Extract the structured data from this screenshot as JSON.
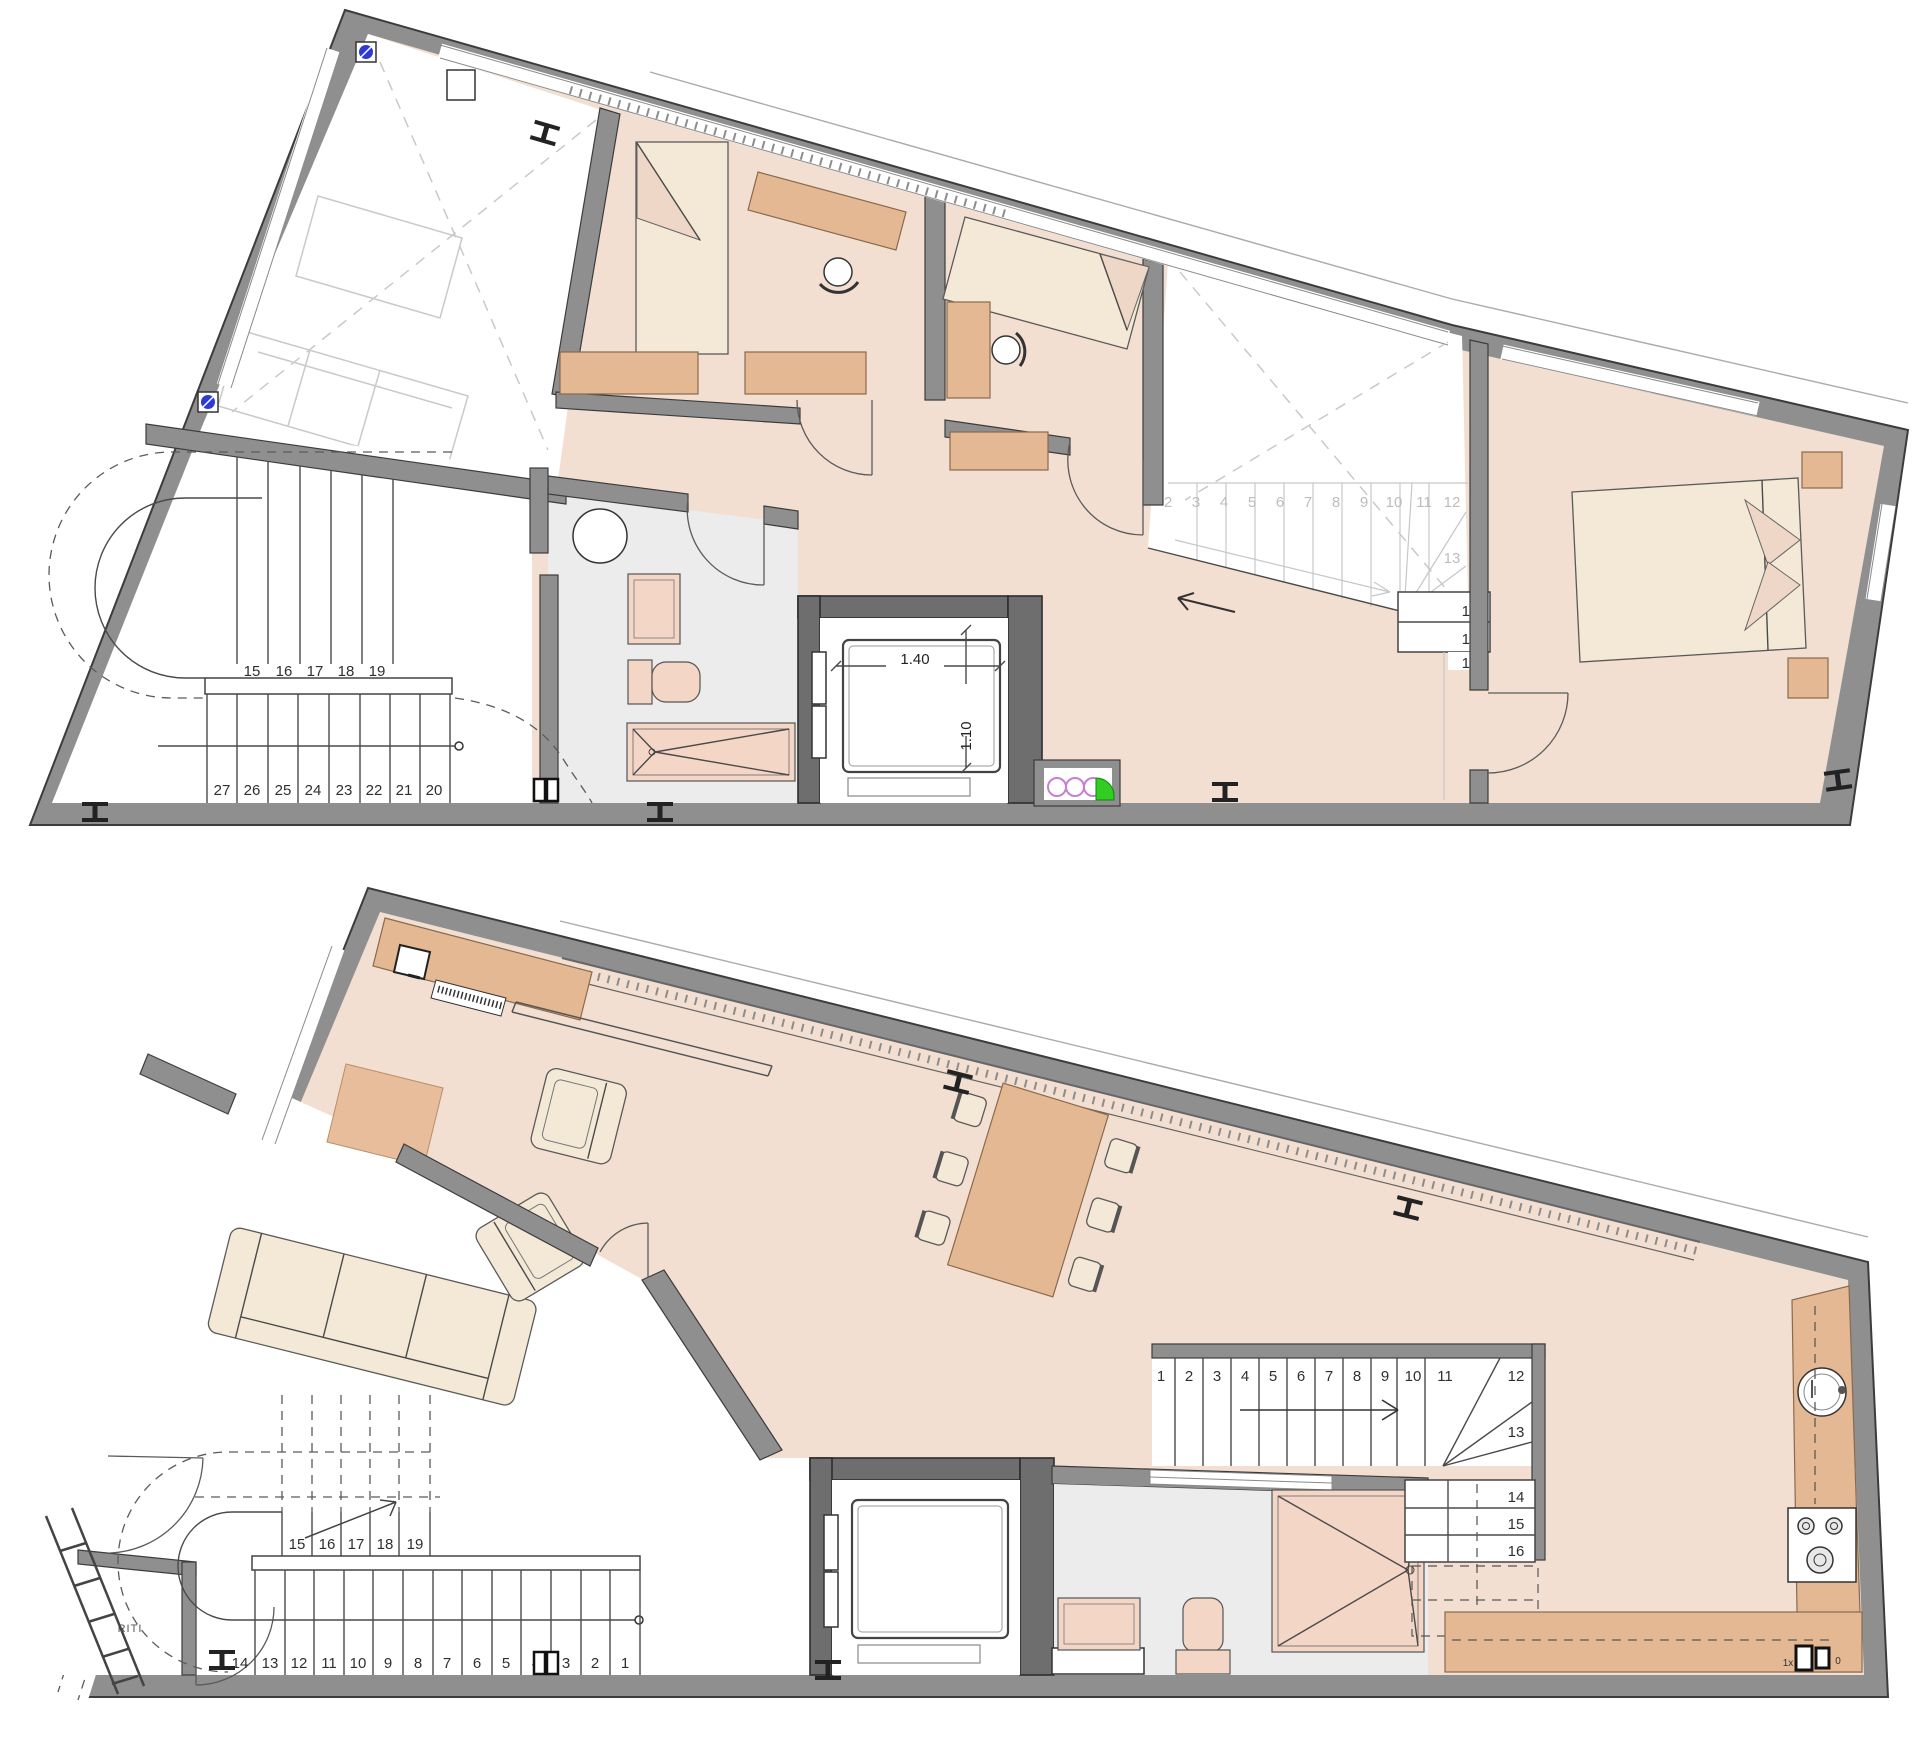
{
  "colors": {
    "wall": "#8f8f8f",
    "wall_dark": "#6e6e6e",
    "floor_peach": "#f2dfd1",
    "floor_gray": "#ececec",
    "accent": "#e3b893",
    "pink": "#f3d6c6",
    "cream": "#f3e9d6",
    "ghost": "#c9c9c9",
    "blue": "#2f3bd0",
    "green": "#33cc22",
    "magenta": "#c97fd0",
    "num": "#2f2f2f",
    "num_faint": "#bdbdbd"
  },
  "upper_floor": {
    "stair_left": {
      "upper_run": [
        "15",
        "16",
        "17",
        "18",
        "19"
      ],
      "lower_run": [
        "27",
        "26",
        "25",
        "24",
        "23",
        "22",
        "21",
        "20"
      ]
    },
    "stair_right": {
      "faint_run": [
        "2",
        "3",
        "4",
        "5",
        "6",
        "7",
        "8",
        "9",
        "10",
        "11"
      ],
      "corner_step": "12",
      "turn_step": "13",
      "lower_steps": [
        "14",
        "15",
        "16"
      ]
    },
    "elevator": {
      "width": "1.40",
      "depth": "1.10"
    }
  },
  "lower_floor": {
    "stair_left": {
      "upper_run": [
        "15",
        "16",
        "17",
        "18",
        "19"
      ],
      "lower_run": [
        "14",
        "13",
        "12",
        "11",
        "10",
        "9",
        "8",
        "7",
        "6",
        "5",
        "4",
        "3",
        "2",
        "1"
      ]
    },
    "stair_right": {
      "run": [
        "1",
        "2",
        "3",
        "4",
        "5",
        "6",
        "7",
        "8",
        "9",
        "10",
        "11"
      ],
      "corner_step": "12",
      "turn_step": "13",
      "lower_steps": [
        "14",
        "15",
        "16"
      ]
    },
    "utility_room_label": "RITI",
    "kitchen_socket_label": "1x",
    "kitchen_socket_label_2": "0"
  }
}
